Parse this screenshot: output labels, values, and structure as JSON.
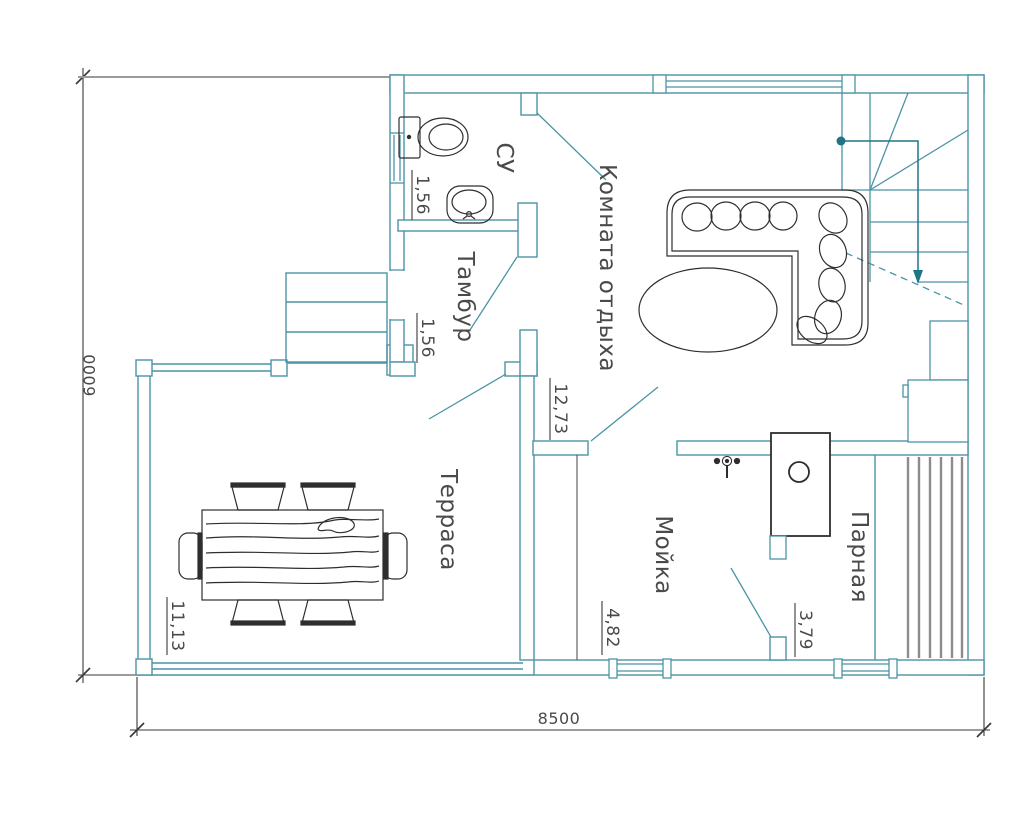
{
  "floorplan": {
    "type": "architectural-floor-plan",
    "rooms": [
      {
        "id": "su",
        "label": "СУ",
        "area": "1,56"
      },
      {
        "id": "tambur",
        "label": "Тамбур",
        "area": "1,56"
      },
      {
        "id": "komnata",
        "label": "Комната отдыха",
        "area": "12,73"
      },
      {
        "id": "terrasa",
        "label": "Терраса",
        "area": "11,13"
      },
      {
        "id": "moyka",
        "label": "Мойка",
        "area": "4,82"
      },
      {
        "id": "parnaya",
        "label": "Парная",
        "area": "3,79"
      }
    ],
    "dimensions": {
      "overall_width": "8500",
      "overall_height": "6000"
    },
    "colors": {
      "wall": "#4b94a5",
      "wall_dark": "#1d7586",
      "furniture": "#2e2e2e",
      "dimension": "#3a3a3a",
      "witness": "#9a9a9a",
      "bench_slat": "#8c8c8c",
      "text": "#4a4a4a",
      "background": "#ffffff"
    }
  }
}
